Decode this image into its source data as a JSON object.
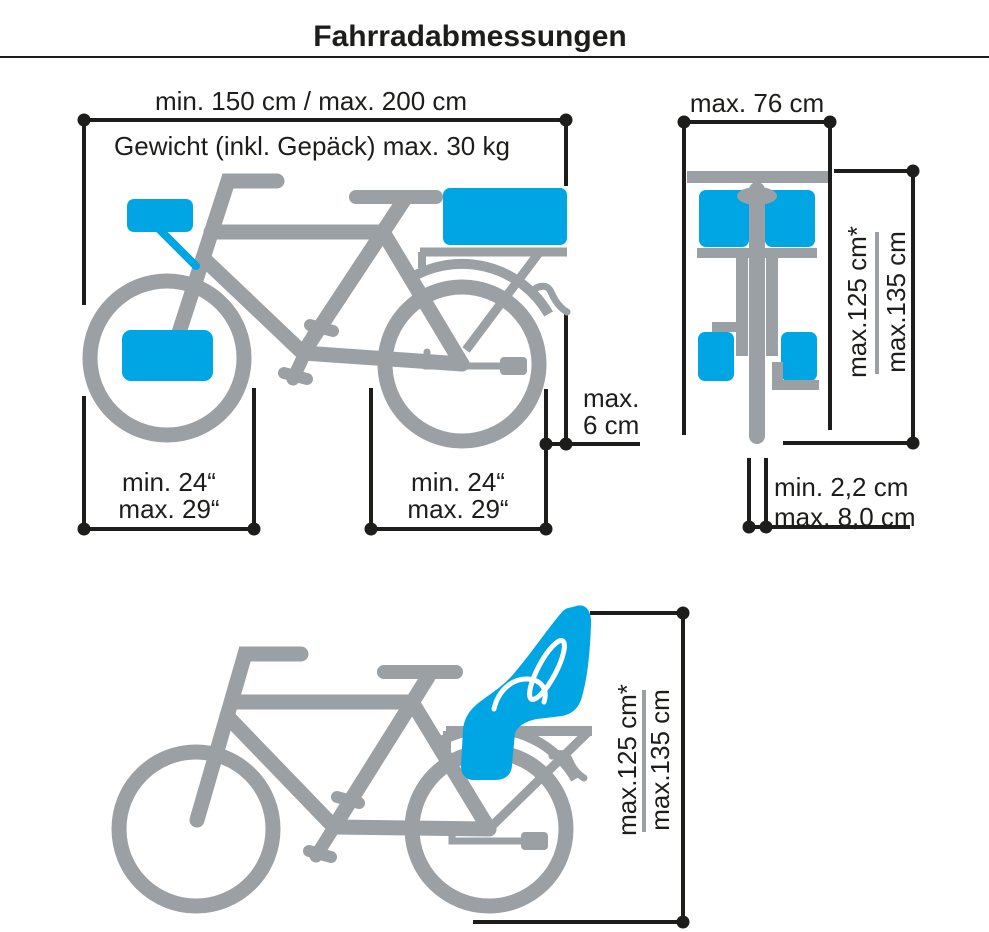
{
  "colors": {
    "accent_blue": "#00a5e4",
    "bike_gray": "#9aa0a3",
    "line_ink": "#1d1d1b"
  },
  "title": "Fahrradabmessungen",
  "side_view": {
    "length_label": "min. 150 cm / max. 200 cm",
    "weight_label": "Gewicht (inkl. Gepäck) max. 30 kg",
    "rear_overhang_line1": "max.",
    "rear_overhang_line2": "6 cm",
    "front_wheel_line1": "min. 24“",
    "front_wheel_line2": "max. 29“",
    "rear_wheel_line1": "min. 24“",
    "rear_wheel_line2": "max. 29“"
  },
  "front_view": {
    "width_label": "max. 76 cm",
    "height_line1": "max.125 cm*",
    "height_line2": "max.135 cm",
    "tire_width_line1": "min. 2,2 cm",
    "tire_width_line2": "max. 8,0 cm"
  },
  "child_seat_view": {
    "height_line1": "max.125 cm*",
    "height_line2": "max.135 cm"
  }
}
